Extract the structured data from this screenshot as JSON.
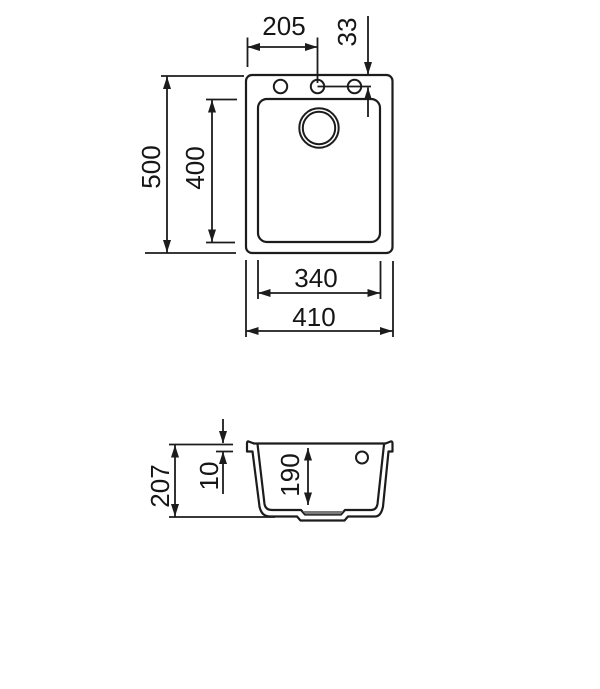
{
  "drawing": {
    "plan_view": {
      "overall_width": "410",
      "overall_depth": "500",
      "bowl_width": "340",
      "bowl_depth": "400",
      "tap_hole_center_offset": "205",
      "tap_hole_edge_offset": "33"
    },
    "section_view": {
      "overall_height": "207",
      "rim_thickness": "10",
      "bowl_inner_depth": "190"
    },
    "colors": {
      "line": "#1c1c1c",
      "drain_fill": "#7a7a7a",
      "background": "#ffffff"
    }
  }
}
